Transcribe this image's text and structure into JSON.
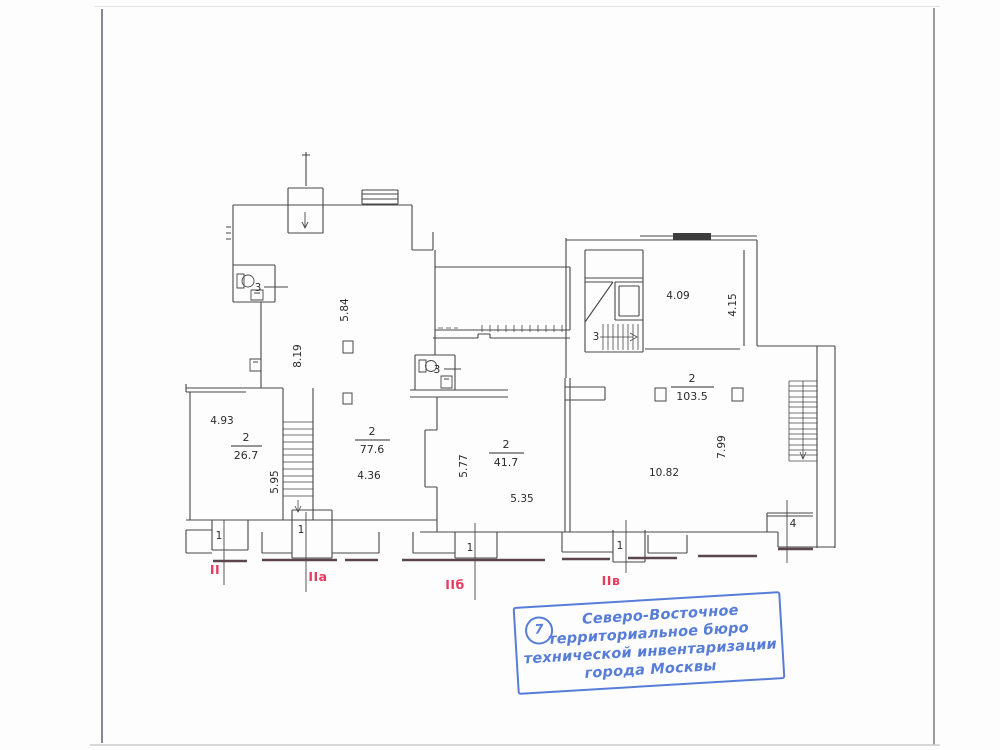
{
  "document": {
    "type": "floor-plan-scan",
    "line_color": "#474747",
    "sidewalk_color": "#5c464e",
    "accent_red": "#e73a5f",
    "stamp_blue": "#4b74d6"
  },
  "plan": {
    "rooms": [
      {
        "number": "2",
        "area": "26.7"
      },
      {
        "number": "2",
        "area": "77.6"
      },
      {
        "number": "2",
        "area": "41.7"
      },
      {
        "number": "2",
        "area": "103.5"
      }
    ],
    "dims": [
      "4.93",
      "5.95",
      "8.19",
      "5.84",
      "4.36",
      "5.77",
      "5.35",
      "4.09",
      "4.15",
      "7.99",
      "10.82"
    ],
    "marks": {
      "toilet_left": "3",
      "toilet_mid": "3",
      "stair": "3",
      "room4": "4",
      "vest1": "1",
      "vest2": "1",
      "vest3": "1",
      "vest4": "1"
    },
    "sections": [
      "II",
      "IIа",
      "IIб",
      "IIв"
    ]
  },
  "stamp": {
    "number": "7",
    "line1": "Северо-Восточное",
    "line2": "территориальное бюро",
    "line3": "технической инвентаризации",
    "line4": "города Москвы"
  }
}
